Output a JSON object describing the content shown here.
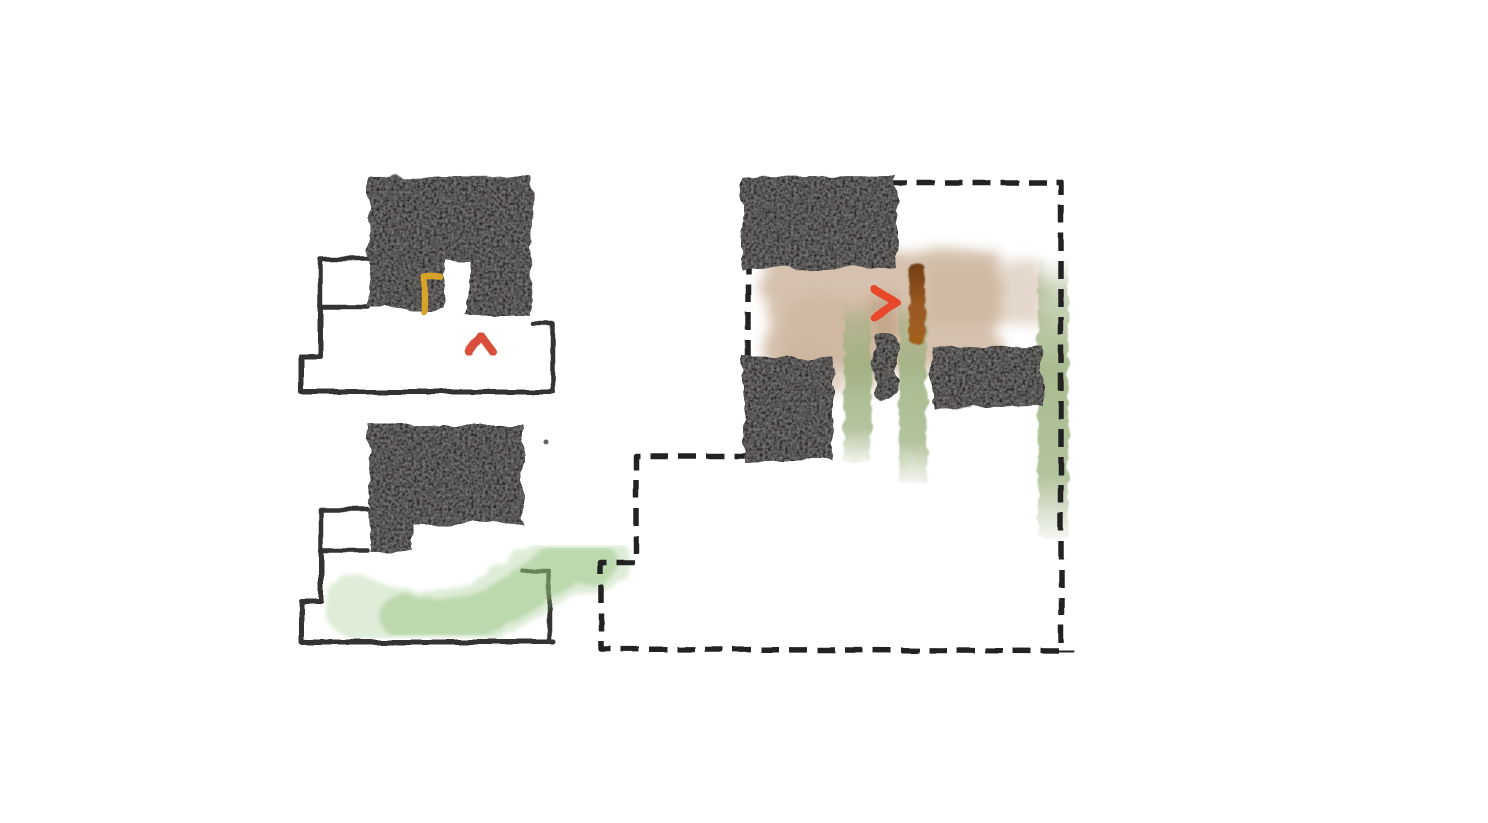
{
  "meta": {
    "kind": "hand-drawn architectural massing / plan concept sketch",
    "canvas_width": 1488,
    "canvas_height": 823,
    "background": "#ffffff"
  },
  "palette": {
    "ink": "#343230",
    "charcoal": "#2a2826",
    "seam": "#55534f",
    "yellow": "#d8a32c",
    "red": "#e8472b",
    "red_soft": "#d9503a",
    "green_left": "#8cbe74",
    "green_right": "#9aaf7c",
    "tan": "#cbb29a",
    "tan_dark": "#b3906e",
    "brown_dark": "#6e3d12",
    "brown": "#9a5820",
    "brown_light": "#a2601f",
    "boundary": "#232220"
  },
  "diagrams": [
    {
      "id": "massing-sketch-step-1",
      "description": "upper-left massing diagram: charcoal volume over stepped pen outline, yellow dashed alignment guide, red arrow pointing up",
      "shapes": [
        {
          "name": "outline-upper-notch",
          "type": "path",
          "d": "M368,259 L320,259 L320,307 L368,307",
          "stroke": "ink",
          "sw": 4.5,
          "filter": "roughInk"
        },
        {
          "name": "outline-left-step",
          "type": "path",
          "d": "M320,307 L320,356 L301,356 L301,392 L553,392",
          "stroke": "ink",
          "sw": 5,
          "filter": "roughInk"
        },
        {
          "name": "outline-right-edge",
          "type": "path",
          "d": "M530,319 L530,391",
          "stroke": "ink",
          "sw": 4.5,
          "filter": "roughInk"
        },
        {
          "name": "outline-right-bump",
          "type": "path",
          "d": "M533,324 L553,324 L553,390",
          "stroke": "ink",
          "sw": 4.5,
          "filter": "roughInk"
        },
        {
          "name": "charcoal-mass",
          "type": "path",
          "d": "M369,177 L531,176 L532,318 L468,318 L468,259 L445,259 L445,309 L369,309 Z",
          "fill": "charcoal",
          "filter": "charcoal"
        },
        {
          "name": "charcoal-seam-horizontal",
          "type": "path",
          "d": "M373,257 L527,255",
          "stroke": "seam",
          "sw": 2.5,
          "opacity": 0.3,
          "filter": "roughInk"
        },
        {
          "name": "charcoal-seam-vertical",
          "type": "path",
          "d": "M457,180 L456,252",
          "stroke": "seam",
          "sw": 2.5,
          "opacity": 0.25,
          "filter": "roughInk"
        },
        {
          "name": "guide-corner-yellow",
          "type": "path",
          "d": "M424,312 L424,277 L440,277",
          "stroke": "yellow",
          "sw": 6.5,
          "filter": "roughInk"
        },
        {
          "name": "guide-dashes-horizontal",
          "type": "path",
          "d": "M449,277 L563,277",
          "stroke": "yellow",
          "sw": 6.5,
          "dash": "13 10",
          "filter": "roughInk"
        },
        {
          "name": "guide-dashes-vertical",
          "type": "path",
          "d": "M424,321 L424,336",
          "stroke": "yellow",
          "sw": 6,
          "dash": "4 10",
          "opacity": 0.9,
          "filter": "roughInk"
        },
        {
          "name": "arrow-up-stem",
          "type": "path",
          "d": "M481,369 L481,347",
          "stroke": "red_soft",
          "sw": 8,
          "filter": "roughInk"
        },
        {
          "name": "arrow-up-head",
          "type": "path",
          "d": "M469,352 L481,336 L493,352",
          "stroke": "red_soft",
          "sw": 8,
          "filter": "roughInk"
        }
      ]
    },
    {
      "id": "massing-sketch-step-2",
      "description": "lower-left massing diagram: charcoal L-volume over stepped pen outline with green brush stroke sweeping right",
      "shapes": [
        {
          "name": "outline-upper-notch",
          "type": "path",
          "d": "M368,510 L321,510 L321,551 L368,551",
          "stroke": "ink",
          "sw": 4.5,
          "filter": "roughInk"
        },
        {
          "name": "outline-left-step",
          "type": "path",
          "d": "M321,551 L321,601 L301,601 L301,642 L553,642",
          "stroke": "ink",
          "sw": 5,
          "filter": "roughInk"
        },
        {
          "name": "outline-right-edge",
          "type": "path",
          "d": "M520,525 L520,642",
          "stroke": "ink",
          "sw": 4.5,
          "filter": "roughInk"
        },
        {
          "name": "outline-right-bump",
          "type": "path",
          "d": "M523,571 L549,571 L549,641",
          "stroke": "ink",
          "sw": 4.5,
          "filter": "roughInk"
        },
        {
          "name": "green-brush-light",
          "type": "path",
          "d": "M356,606 C408,629 460,631 510,596 C543,571 572,558 598,561",
          "stroke": "green_left",
          "sw": 64,
          "opacity": 0.28,
          "filter": "brush"
        },
        {
          "name": "green-brush-dense",
          "type": "path",
          "d": "M402,616 C450,628 487,617 526,588 C552,568 575,560 595,563",
          "stroke": "green_left",
          "sw": 44,
          "opacity": 0.42,
          "filter": "brush"
        },
        {
          "name": "charcoal-mass",
          "type": "path",
          "d": "M369,424 L523,424 L523,524 L413,524 L413,551 L369,551 Z",
          "fill": "charcoal",
          "filter": "charcoal"
        },
        {
          "name": "speck-dot",
          "type": "circle",
          "cx": 546,
          "cy": 442,
          "r": 2.5,
          "fill": "ink",
          "opacity": 0.75
        }
      ]
    },
    {
      "id": "plan-diagram-right",
      "description": "right plan diagram: dashed site boundary, charcoal blocks, tan watercolor wash, vertical green strokes, brown stroke, red arrow pointing right",
      "shapes": [
        {
          "name": "tan-wash-main",
          "type": "rect",
          "x": 765,
          "y": 252,
          "w": 235,
          "h": 120,
          "fill": "tan",
          "opacity": 0.8,
          "filter": "wash"
        },
        {
          "name": "tan-wash-lower-left",
          "type": "rect",
          "x": 783,
          "y": 300,
          "w": 105,
          "h": 88,
          "fill": "tan",
          "opacity": 0.5,
          "filter": "wash"
        },
        {
          "name": "tan-wash-right-streaks",
          "type": "rect",
          "x": 928,
          "y": 263,
          "w": 118,
          "h": 62,
          "fill": "tan",
          "opacity": 0.5,
          "filter": "wash"
        },
        {
          "name": "tan-wash-below",
          "type": "rect",
          "x": 772,
          "y": 348,
          "w": 58,
          "h": 48,
          "fill": "tan",
          "opacity": 0.35,
          "filter": "wash"
        },
        {
          "name": "tan-strip-dark",
          "type": "rect",
          "x": 872,
          "y": 296,
          "w": 26,
          "h": 44,
          "fill": "tan_dark",
          "opacity": 0.45,
          "filter": "wash"
        },
        {
          "name": "green-stroke-left",
          "type": "rect",
          "x": 844,
          "y": 303,
          "w": 27,
          "h": 160,
          "gradient": "gradGreenV",
          "filter": "paint"
        },
        {
          "name": "green-stroke-middle",
          "type": "rect",
          "x": 899,
          "y": 299,
          "w": 28,
          "h": 183,
          "gradient": "gradGreenV",
          "filter": "paint"
        },
        {
          "name": "green-stroke-right",
          "type": "rect",
          "x": 1038,
          "y": 257,
          "w": 30,
          "h": 280,
          "gradient": "gradGreenV",
          "filter": "paint"
        },
        {
          "name": "site-boundary-dashed",
          "type": "path",
          "d": "M748,182 L1061,182 L1061,651 L601,649 L601,563 L636,563 L636,456 L748,456 Z",
          "stroke": "boundary",
          "sw": 5.5,
          "dash": "18 10",
          "cap": "butt",
          "filter": "roughDash"
        },
        {
          "name": "boundary-tick-top-right",
          "type": "path",
          "d": "M1061,170 L1061,199",
          "stroke": "boundary",
          "sw": 5,
          "filter": "roughDash"
        },
        {
          "name": "boundary-tick-bottom-right",
          "type": "path",
          "d": "M1060,638 L1060,665",
          "stroke": "boundary",
          "sw": 5,
          "filter": "roughDash"
        },
        {
          "name": "boundary-tick-bottom-right-cross",
          "type": "path",
          "d": "M1048,652 L1072,651",
          "stroke": "boundary",
          "sw": 5,
          "filter": "roughDash"
        },
        {
          "name": "charcoal-block-top-left",
          "type": "path",
          "d": "M741,177 L896,176 L896,268 L741,269 Z",
          "fill": "charcoal",
          "filter": "charcoal"
        },
        {
          "name": "charcoal-block-mid-left",
          "type": "path",
          "d": "M743,357 L833,357 L833,461 L743,461 Z",
          "fill": "charcoal",
          "filter": "charcoal"
        },
        {
          "name": "charcoal-block-small",
          "type": "rect",
          "x": 874,
          "y": 333,
          "w": 23,
          "h": 68,
          "rx": 9,
          "fill": "charcoal",
          "filter": "charcoal"
        },
        {
          "name": "charcoal-block-right",
          "type": "path",
          "d": "M932,347 L1043,346 L1043,406 L932,407 Z",
          "fill": "charcoal",
          "filter": "charcoal"
        },
        {
          "name": "brown-stroke",
          "type": "rect",
          "x": 909,
          "y": 263,
          "w": 16,
          "h": 82,
          "rx": 7,
          "gradient": "gradBrown",
          "filter": "paint"
        },
        {
          "name": "arrow-right-stem",
          "type": "path",
          "d": "M829,303 L880,303",
          "stroke": "red",
          "sw": 8,
          "filter": "roughInk"
        },
        {
          "name": "arrow-right-head",
          "type": "path",
          "d": "M874,289 L897,303 L874,317",
          "stroke": "red",
          "sw": 8,
          "filter": "roughInk"
        }
      ]
    }
  ]
}
